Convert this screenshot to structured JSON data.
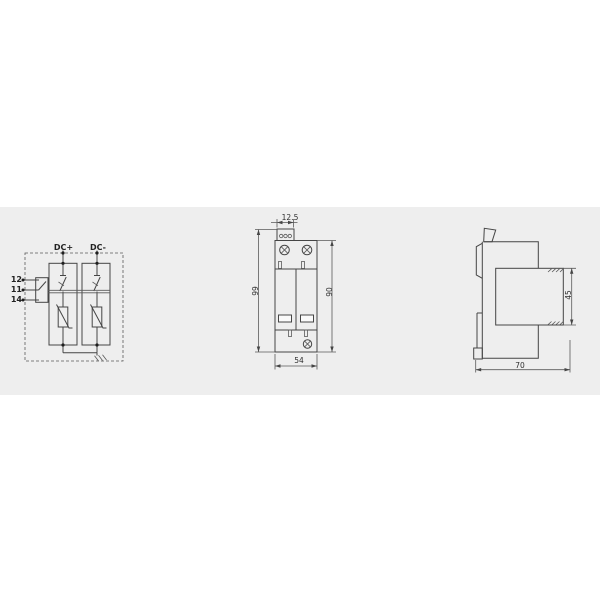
{
  "document": {
    "type": "technical-dimension-drawing",
    "subject": "DIN-rail surge protective device, 2-pole DC"
  },
  "views": {
    "circuit": {
      "dc_plus": "DC+",
      "dc_minus": "DC-",
      "t12": "12",
      "t11": "11",
      "t14": "14",
      "symbols": [
        "remote-signal-changeover-contact",
        "thermal-disconnector",
        "varistor",
        "varistor",
        "earth-ground"
      ]
    },
    "front": {
      "dim_terminal_width": "12.5",
      "dim_height_total": "99",
      "dim_height_body": "90",
      "dim_width": "54"
    },
    "side": {
      "dim_module_height": "45",
      "dim_depth": "70"
    }
  },
  "colors": {
    "background": "#ffffff",
    "band": "#eeeeee",
    "line": "#454545",
    "text": "#2f2f2f"
  }
}
